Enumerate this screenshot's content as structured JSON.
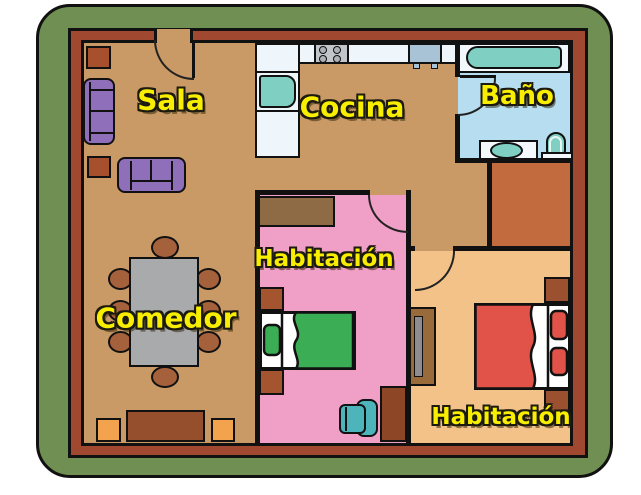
{
  "rooms": {
    "sala": {
      "label": "Sala",
      "floor_color": "#c99a66"
    },
    "cocina": {
      "label": "Cocina",
      "floor_color": "#c99a66"
    },
    "bano": {
      "label": "Baño",
      "floor_color": "#b7def0"
    },
    "habitacion_1": {
      "label": "Habitación",
      "floor_color": "#f09fc7"
    },
    "comedor": {
      "label": "Comedor",
      "floor_color": "#c99a66"
    },
    "habitacion_2": {
      "label": "Habitación",
      "floor_color": "#f3c289"
    }
  },
  "palette": {
    "border_green": "#6f9052",
    "wall_red": "#a14831",
    "outline_black": "#111111",
    "label_yellow": "#f8ef00",
    "hall_terracotta": "#c26b3e",
    "counter_white": "#eef5fb",
    "fixture_teal": "#7fcfc3",
    "appliance_gray": "#c2c5c9",
    "fridge_blue": "#a8c2d6",
    "sofa_purple": "#8f6fba",
    "side_table_red": "#a6502e",
    "dining_table_gray": "#a9aaac",
    "chair_wood_brown": "#a5613c",
    "sideboard_brown": "#964f2c",
    "stool_orange": "#f3a24e",
    "closet_brown": "#8f6b45",
    "nightstand_brown": "#a4552f",
    "bed_green": "#3bae55",
    "bed_red": "#e15349",
    "desk_brown": "#8e4726",
    "dresser_brown": "#996a3a",
    "office_chair_teal": "#4db4bc"
  }
}
